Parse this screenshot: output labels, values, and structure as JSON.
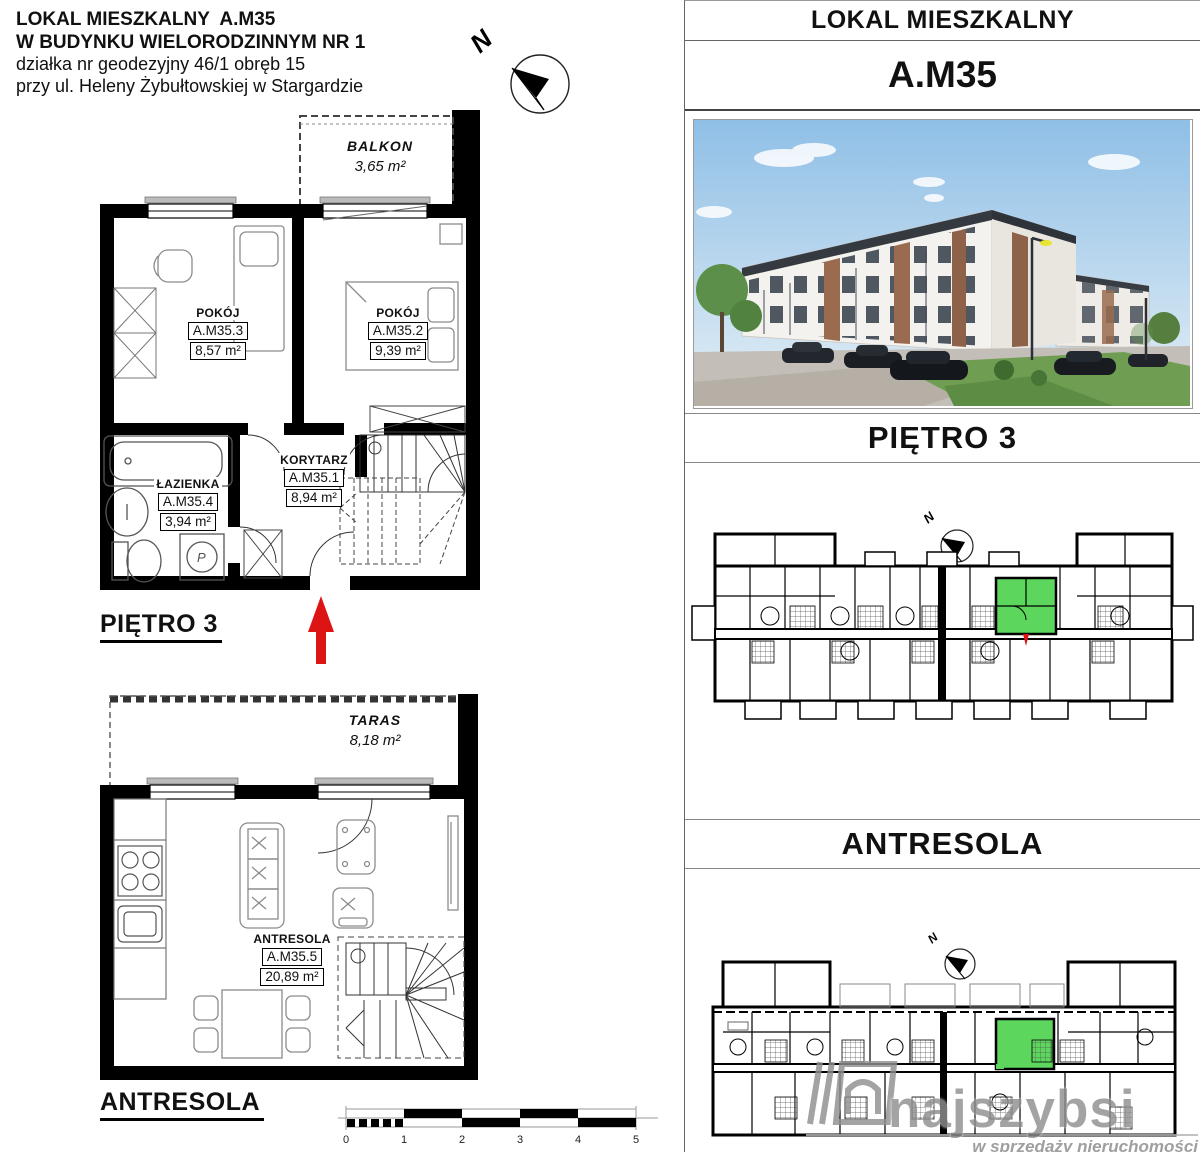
{
  "title_block": {
    "line1": "LOKAL MIESZKALNY  A.M35",
    "line2": "W BUDYNKU WIELORODZINNYM NR 1",
    "line3": "działka nr geodezyjny 46/1 obręb 15",
    "line4": "przy ul. Heleny Żybułtowskiej w Stargardzie"
  },
  "compass": {
    "label": "N"
  },
  "plan_pietro3": {
    "heading": "PIĘTRO 3",
    "balkon_name": "BALKON",
    "balkon_area": "3,65 m²",
    "rooms": {
      "pokoj3": {
        "name": "POKÓJ",
        "id": "A.M35.3",
        "area": "8,57 m²"
      },
      "pokoj2": {
        "name": "POKÓJ",
        "id": "A.M35.2",
        "area": "9,39 m²"
      },
      "lazienka": {
        "name": "ŁAZIENKA",
        "id": "A.M35.4",
        "area": "3,94 m²"
      },
      "korytarz": {
        "name": "KORYTARZ",
        "id": "A.M35.1",
        "area": "8,94 m²"
      }
    }
  },
  "plan_antresola": {
    "heading": "ANTRESOLA",
    "taras_name": "TARAS",
    "taras_area": "8,18 m²",
    "room": {
      "name": "ANTRESOLA",
      "id": "A.M35.5",
      "area": "20,89 m²"
    }
  },
  "scale_bar": {
    "labels": [
      "0",
      "1",
      "2",
      "3",
      "4",
      "5"
    ]
  },
  "right_panel": {
    "title": "LOKAL MIESZKALNY",
    "unit": "A.M35",
    "floor_title": "PIĘTRO 3",
    "antresola_title": "ANTRESOLA"
  },
  "watermark": {
    "brand": "najszybsi",
    "tagline": "w sprzedaży nieruchomości"
  },
  "colors": {
    "highlight_green": "#5cd65c",
    "arrow_red": "#dd1414",
    "wall_black": "#000000",
    "furniture_gray": "#8c8c8c",
    "watermark_gray": "#8f8f8f"
  }
}
